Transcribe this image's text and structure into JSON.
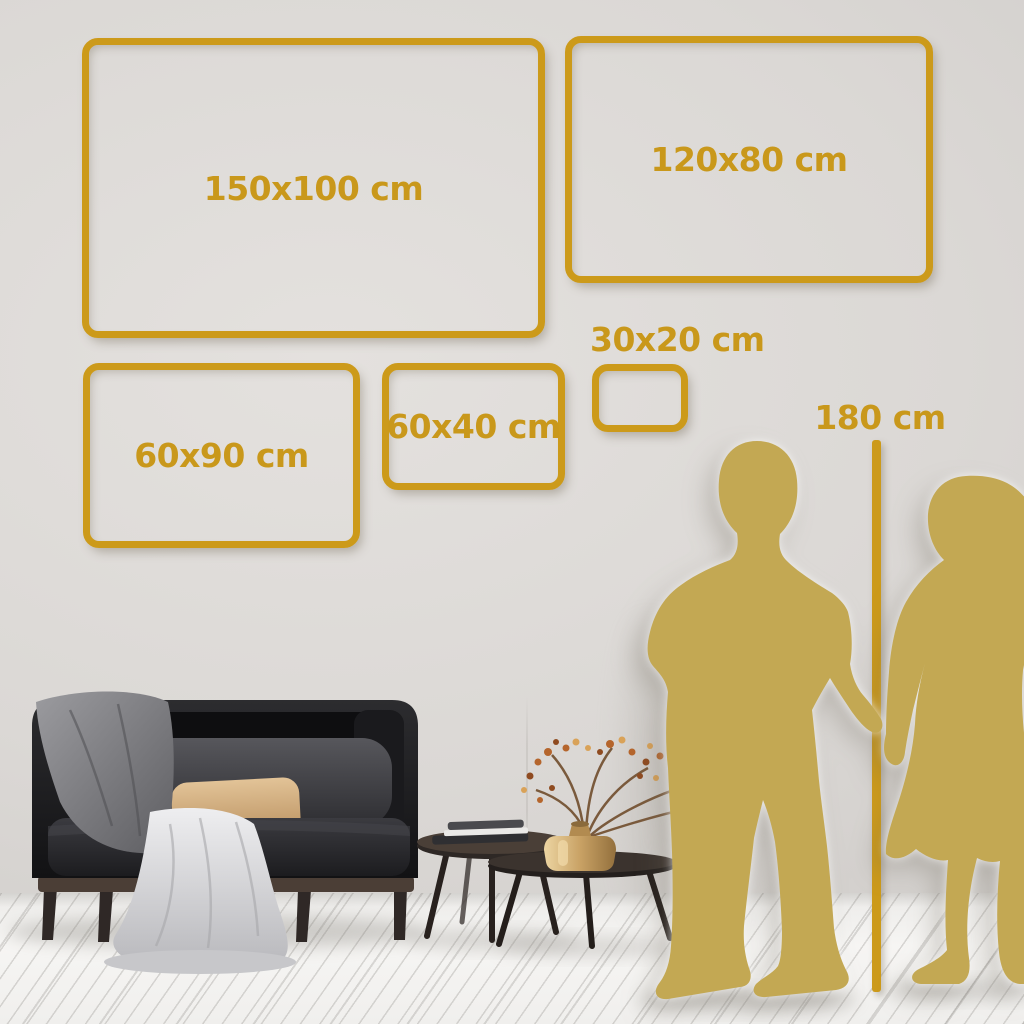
{
  "size_guide": {
    "frames": [
      {
        "label": "150x100 cm",
        "width_cm": 150,
        "height_cm": 100
      },
      {
        "label": "120x80 cm",
        "width_cm": 120,
        "height_cm": 80
      },
      {
        "label": "60x90 cm",
        "width_cm": 60,
        "height_cm": 90
      },
      {
        "label": "60x40 cm",
        "width_cm": 60,
        "height_cm": 40
      },
      {
        "label": "30x20 cm",
        "width_cm": 30,
        "height_cm": 20
      }
    ],
    "height_reference": {
      "label": "180 cm",
      "value_cm": 180
    }
  },
  "colors": {
    "accent_gold": "#CC9A1A",
    "silhouette_gold": "#C3A853",
    "wall": "#DBD8D5",
    "floor": "#F3F2F0"
  },
  "scene": {
    "figures": [
      "man-silhouette",
      "woman-silhouette"
    ],
    "furniture": [
      "sofa",
      "gray-blanket",
      "nesting-coffee-tables",
      "books",
      "brass-vase",
      "dried-branch"
    ]
  }
}
